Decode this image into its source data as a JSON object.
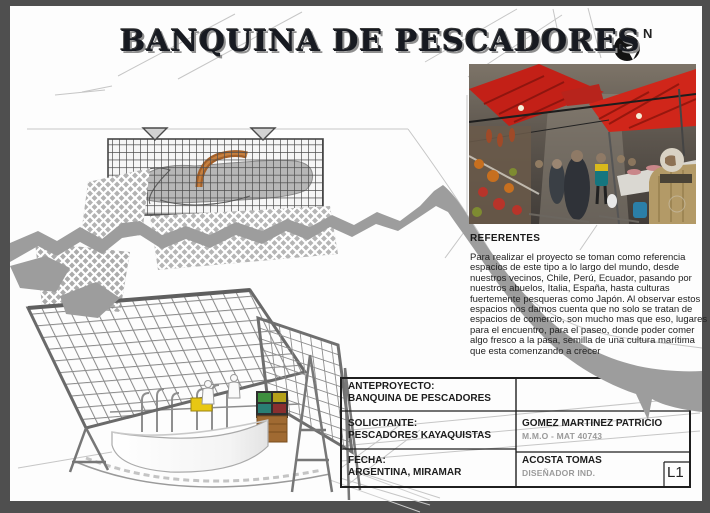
{
  "sheet": {
    "title": "BANQUINA DE PESCADORES",
    "north_label": "N",
    "sheet_number": "L1"
  },
  "referentes": {
    "heading": "REFERENTES",
    "body": "Para realizar el proyecto se toman como referencia espacios de este tipo a lo largo del mundo, desde nuestros vecinos, Chile, Perú, Ecuador, pasando por nuestros abuelos, Italia, España, hasta culturas fuertemente pesqueras como Japón.  Al observar estos espacios nos damos cuenta que no solo se tratan de espacios de comercio, son mucho mas que eso, lugares para el encuentro, para el paseo, donde poder comer algo fresco a la pasa, semilla de una cultura marítima que esta comenzando a crecer"
  },
  "title_block": {
    "anteproyecto_label": "ANTEPROYECTO:",
    "anteproyecto_value": "BANQUINA DE PESCADORES",
    "solicitante_label": "SOLICITANTE:",
    "solicitante_value": "PESCADORES KAYAQUISTAS",
    "fecha_label": "FECHA:",
    "fecha_value": "ARGENTINA, MIRAMAR",
    "professional_1_name": "GOMEZ MARTINEZ PATRICIO",
    "professional_1_detail": "M.M.O - MAT 40743",
    "professional_2_name": "ACOSTA TOMAS",
    "professional_2_detail": "DISEÑADOR IND.",
    "sheet_number": "L1"
  },
  "colors": {
    "background_frame": "#4f4f4f",
    "sheet": "#fdfdfd",
    "band_gray": "#9d9d9d",
    "title_text": "#171a21",
    "awning_red": "#c8221a",
    "ribbon_orange": "#a35f28",
    "crate_yellow": "#e8c713"
  }
}
